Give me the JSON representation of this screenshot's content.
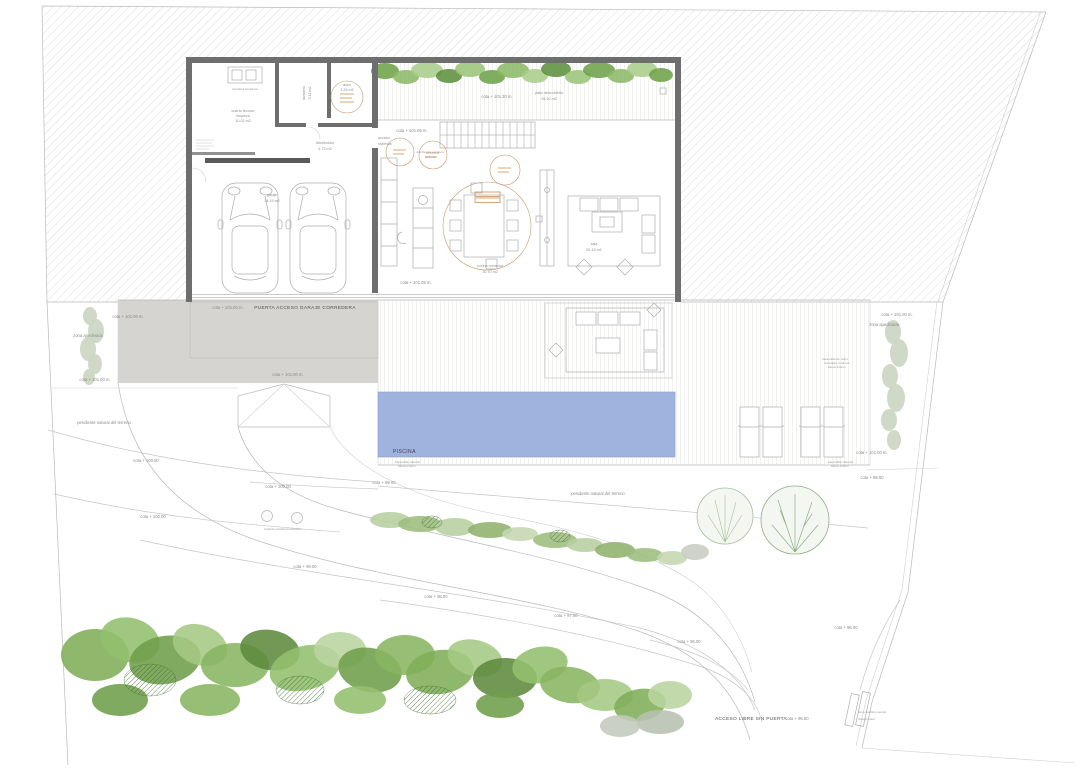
{
  "site": {
    "cota_101_00": "cota + 101.00 m.",
    "cota_101_05": "cota + 101.05 m.",
    "cota_101_30": "cota + 101.30 m.",
    "cota_100_50": "cota + 100.50",
    "cota_100_00": "cota + 100.00",
    "cota_99_00": "cota + 99.00",
    "cota_98_50": "cota + 98.50",
    "cota_98_00": "cota + 98.00",
    "cota_97_00": "cota + 97.00",
    "cota_96_00": "cota + 96.00",
    "cota_95_50": "cota + 95.50",
    "puerta_garaje": "PUERTA ACCESO GARAJE CORREDERA",
    "acceso_libre": "ACCESO LIBRE SIN PUERTA",
    "piscina": "PISCINA",
    "zona_ajardinada": "zona ajardinada",
    "pendiente": "pendiente natural del terreno",
    "bolardo": "bolardo retráctil automático",
    "casillero_1": "zona casillero postal",
    "casillero_2": "videoportero",
    "barandilla_1": "barandilla cabezal",
    "barandilla_2": "altura 110cm",
    "vidrio_1": "barandilla de vidrio",
    "vidrio_2": "templado continua",
    "vidrio_3": "altura 110cm"
  },
  "rooms": {
    "cuarto_tecnico_1": "cuarto técnico",
    "cuarto_tecnico_2": "limpieza",
    "cuarto_tecnico_3": "10.02 m2",
    "lavadora": "lavadora secadora",
    "lavadero_1": "lavadero",
    "lavadero_2": "3.11 m2",
    "aseo_1": "aseo",
    "aseo_2": "3.26 m2",
    "distribuidor_1": "distribuidor",
    "distribuidor_2": "4.73 m2",
    "garaje_1": "garaje",
    "garaje_2": "34.19 m2",
    "acceso_1": "acceso",
    "acceso_2": "vivienda",
    "dist_escalera_1": "distribuidor escalera",
    "dist_escalera_2": "11.9 m2",
    "cocina_1": "cocina comedor",
    "cocina_2": "30.70 m2",
    "sala_1": "sala",
    "sala_2": "52.15 m2",
    "patio_1": "patio descubierto",
    "patio_2": "26.10 m2"
  },
  "colors": {
    "pool": "#a0b3df",
    "paving": "#d6d4d1",
    "wall": "#6e6e6e",
    "hatch_line": "#dcdcdc",
    "annotation": "#c69a6a",
    "vegetation": [
      "#87b561",
      "#6f9e4b",
      "#a5c883",
      "#5d8a3e",
      "#b9d4a1",
      "#7fae58",
      "#93bf6d"
    ]
  }
}
